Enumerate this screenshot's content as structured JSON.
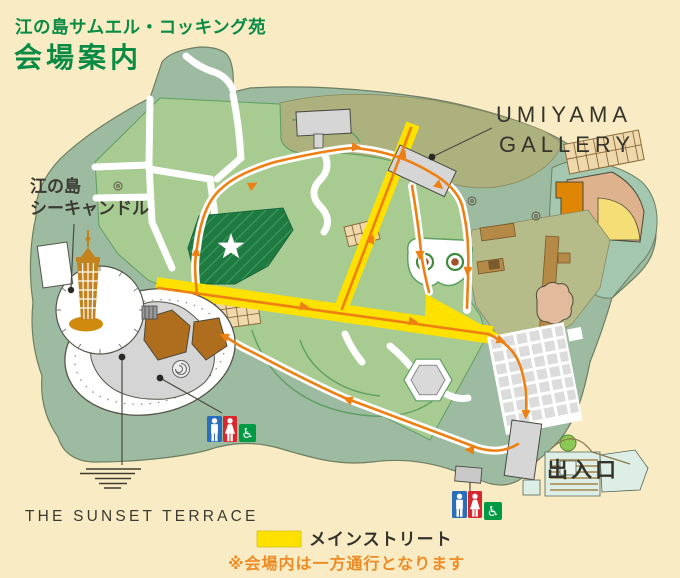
{
  "header": {
    "subtitle": "江の島サムエル・コッキング苑",
    "title": "会場案内"
  },
  "map_labels": {
    "umiyama_line1": "UMIYAMA",
    "umiyama_line2": "GALLERY",
    "sea_candle_line1": "江の島",
    "sea_candle_line2": "シーキャンドル",
    "sunset_terrace": "THE SUNSET TERRACE",
    "exit": "出入口"
  },
  "legend": {
    "main_street": "メインストリート",
    "note": "※会場内は一方通行となります"
  },
  "icons": {
    "wheelchair_symbol": "♿",
    "star_symbol": "white-star",
    "restroom_male": "male-figure",
    "restroom_female": "female-figure"
  },
  "colors": {
    "background": "#F9ECC4",
    "title_green": "#0A8B45",
    "island_sage": "#9DBBA0",
    "garden_green": "#A8CB91",
    "olive_band": "#ACB17E",
    "star_bed_green": "#1E7A40",
    "main_street_yellow": "#FFE100",
    "route_orange": "#EE7F12",
    "note_orange": "#ED8C26",
    "restroom_blue": "#2A6EBB",
    "restroom_red": "#D7282F",
    "accessible_green": "#009A44",
    "tower_brown": "#C3831F"
  }
}
